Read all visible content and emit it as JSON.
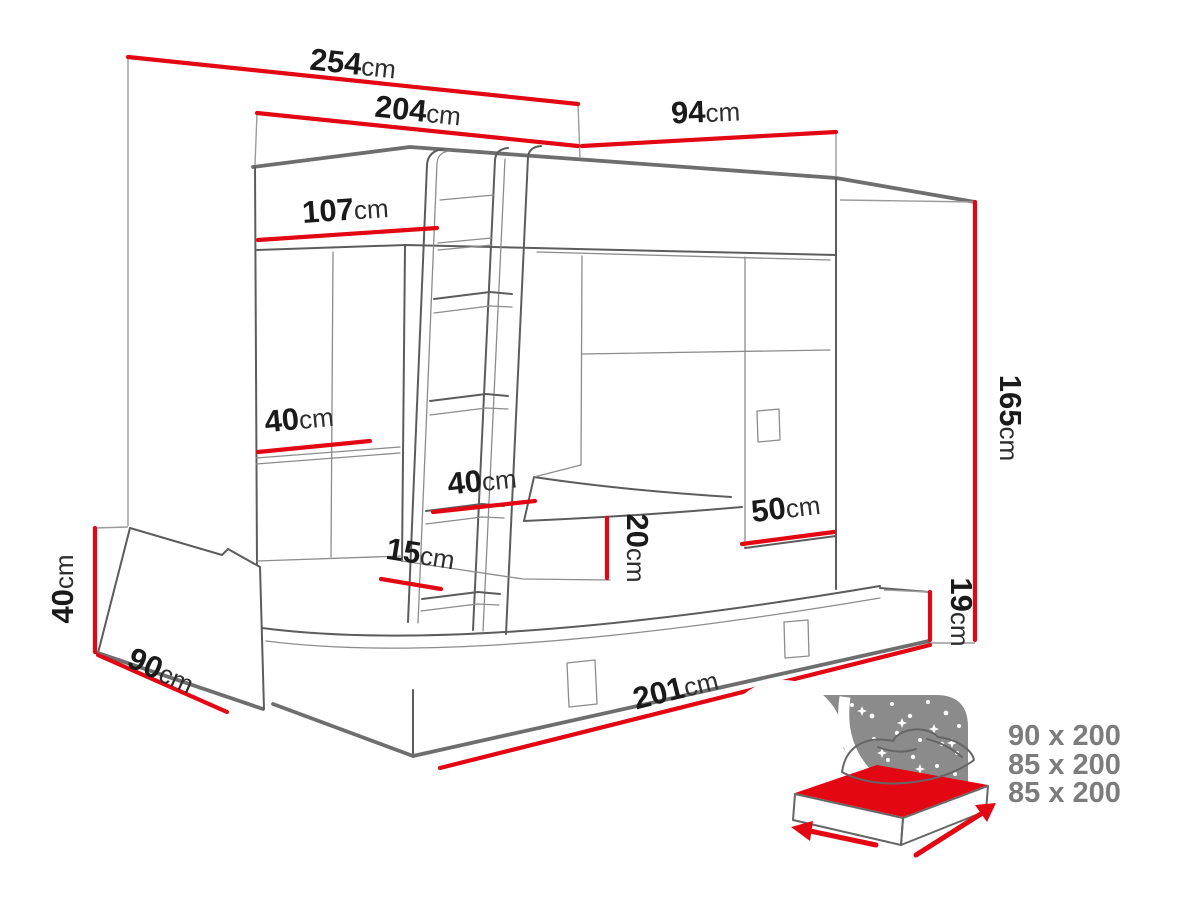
{
  "diagram_title": "bunk bed with pull-out bed - dimension diagram",
  "dims": {
    "d254": {
      "v": "254",
      "u": "cm"
    },
    "d204": {
      "v": "204",
      "u": "cm"
    },
    "d94": {
      "v": "94",
      "u": "cm"
    },
    "d107": {
      "v": "107",
      "u": "cm"
    },
    "d40door": {
      "v": "40",
      "u": "cm"
    },
    "d40ladder": {
      "v": "40",
      "u": "cm"
    },
    "d15": {
      "v": "15",
      "u": "cm"
    },
    "d20": {
      "v": "20",
      "u": "cm"
    },
    "d50": {
      "v": "50",
      "u": "cm"
    },
    "d165": {
      "v": "165",
      "u": "cm"
    },
    "d19": {
      "v": "19",
      "u": "cm"
    },
    "d40height": {
      "v": "40",
      "u": "cm"
    },
    "d90": {
      "v": "90",
      "u": "cm"
    },
    "d201": {
      "v": "201",
      "u": "cm"
    }
  },
  "icon": {
    "sizes": [
      "90 x 200",
      "85 x 200",
      "85 x 200"
    ]
  },
  "colors": {
    "dimension_red": "#e30613",
    "outline_gray": "#5c5c5c",
    "icon_gray": "#8b8b8b",
    "size_text_gray": "#7c7c7c",
    "label_text": "#1a1a1a",
    "background": "#ffffff"
  }
}
